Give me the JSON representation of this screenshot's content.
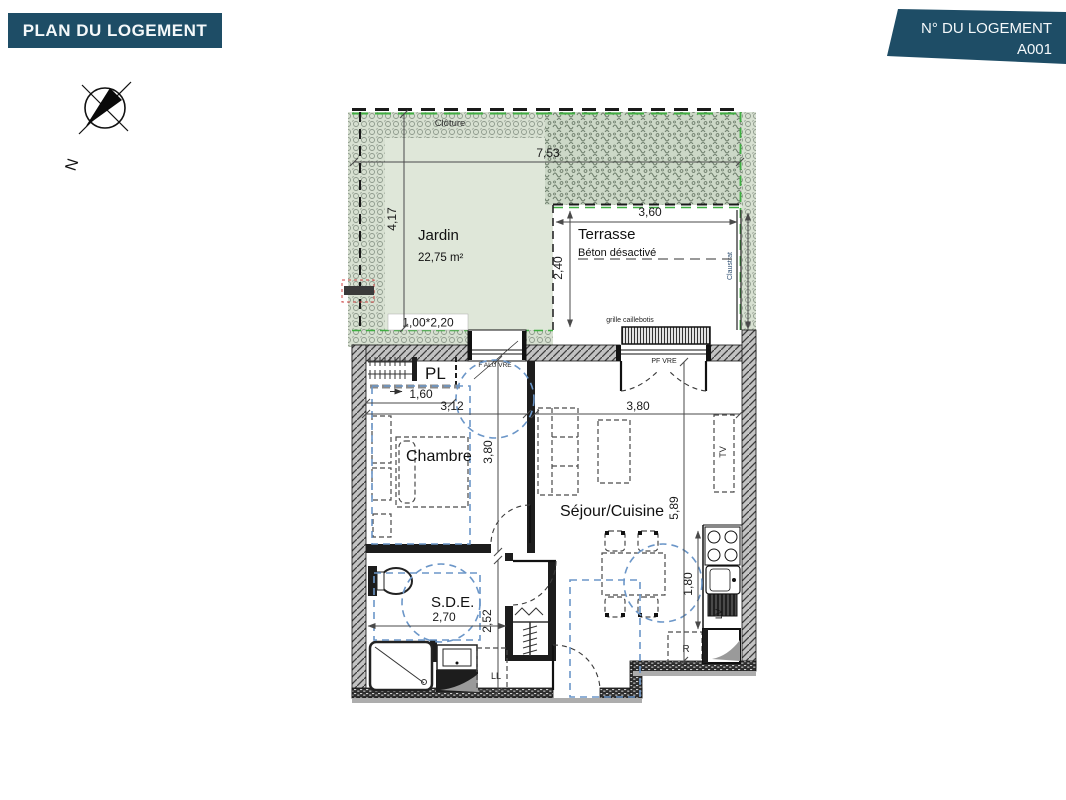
{
  "header": {
    "title": "PLAN DU LOGEMENT"
  },
  "badge": {
    "label": "N° DU LOGEMENT",
    "value": "A001"
  },
  "compass": {
    "north": "N"
  },
  "outdoor": {
    "cloture": "Clôture",
    "jardin_name": "Jardin",
    "jardin_area": "22,75 m²",
    "terrasse_name": "Terrasse",
    "terrasse_finish": "Béton désactivé",
    "claustra": "Claustrat",
    "grille": "grille caillebotis"
  },
  "rooms": {
    "pl": "PL",
    "chambre": "Chambre",
    "sejour": "Séjour/Cuisine",
    "sde": "S.D.E."
  },
  "openings": {
    "chambre_window": "F ALU VRE",
    "sejour_window": "PF VRE",
    "portal_size": "1,00*2,20"
  },
  "equipment": {
    "tv": "TV",
    "lv": "LV",
    "ll": "LL",
    "fridge": "R"
  },
  "dims": {
    "jardin_w": "7,53",
    "jardin_h": "4,17",
    "terrasse_w": "3,60",
    "terrasse_d": "2,40",
    "pl_w": "1,60",
    "chambre_w": "3,12",
    "chambre_d": "3,80",
    "sejour_w": "3,80",
    "sejour_h": "5,89",
    "kitchen_l": "1,80",
    "sde_w": "2,70",
    "sde_d": "2,52"
  },
  "colors": {
    "banner_blue": "#1e4d66",
    "lawn_green": "#dfe7d9",
    "fence_green": "#3fae41",
    "accessibility_blue": "#6b96c8"
  }
}
